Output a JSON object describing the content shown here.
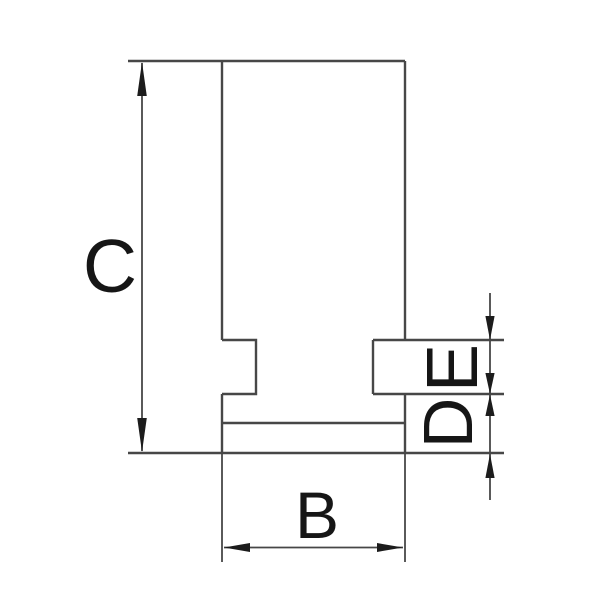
{
  "drawing": {
    "type": "technical-drawing",
    "subject": "jaw cross-section with dimension callouts",
    "labels": {
      "c": "C",
      "b": "B",
      "d": "D",
      "e": "E"
    },
    "colors": {
      "background": "#ffffff",
      "line": "#474747",
      "text": "#161616",
      "arrow": "#1c1c1c"
    }
  }
}
